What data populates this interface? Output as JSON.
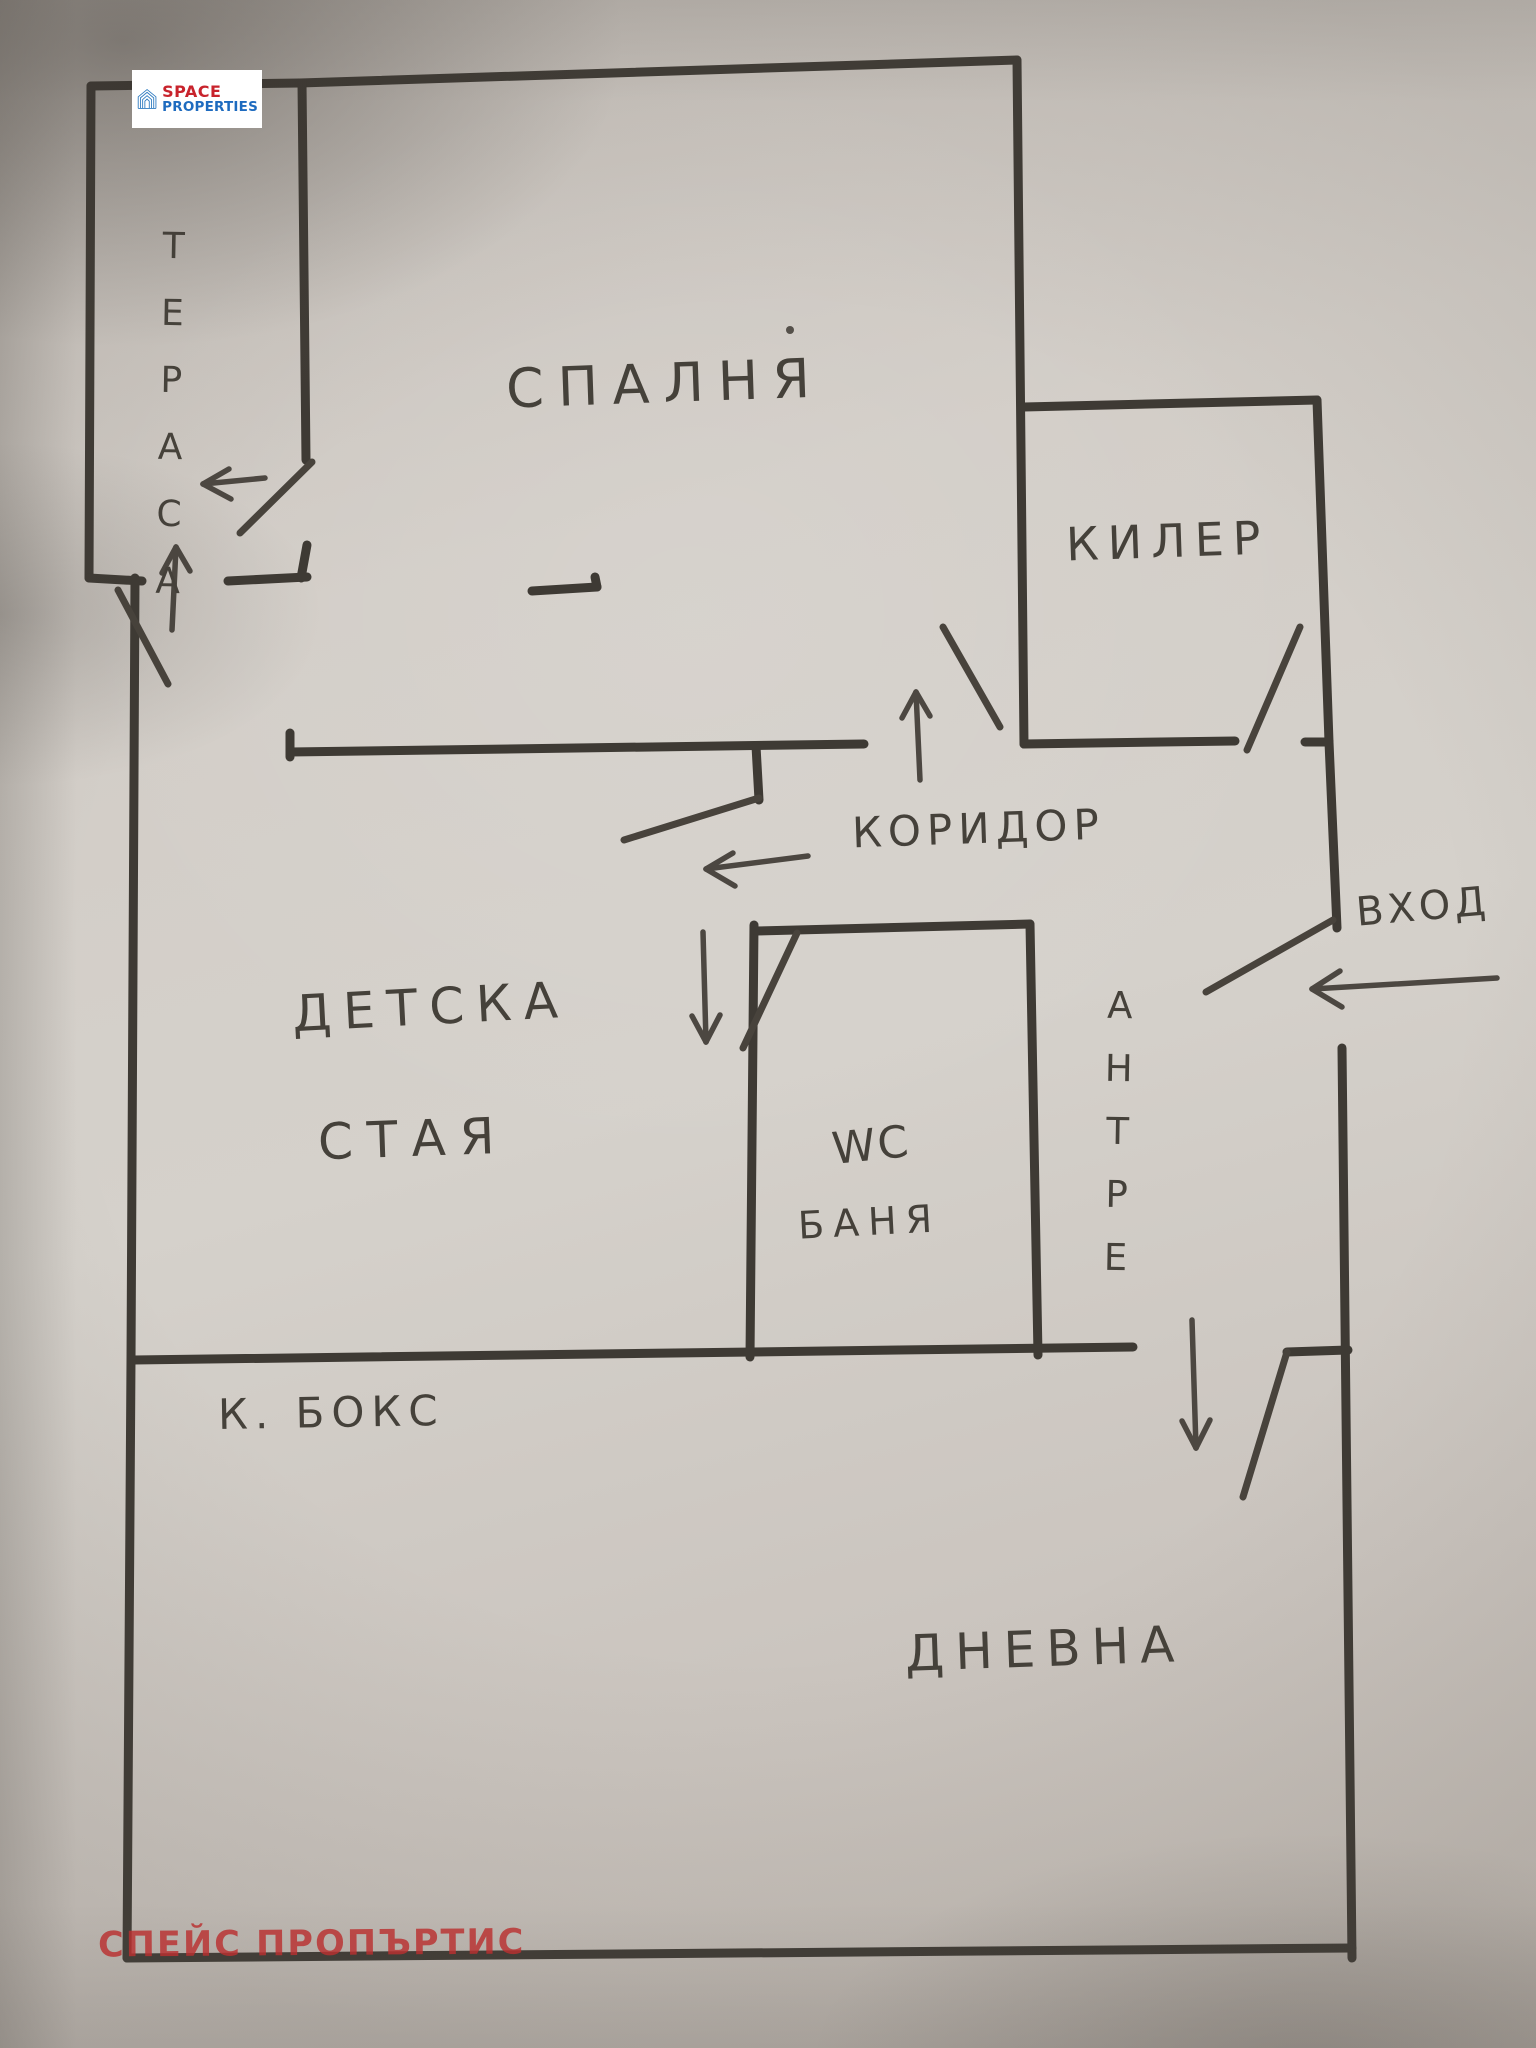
{
  "photo": {
    "description": "hand-drawn apartment floor plan sketch on paper"
  },
  "logo": {
    "space": "SPACE",
    "properties": "PROPERTIES"
  },
  "watermark": {
    "text": "СПЕЙС ПРОПЪРТИС"
  },
  "rooms": {
    "terrace": "ТЕРАСА",
    "bedroom": "СПАЛНЯ",
    "closet": "КИЛЕР",
    "corridor": "КОРИДОР",
    "entrance": "ВХОД",
    "hallway": "АНТРЕ",
    "kids_room_line1": "ДЕТСКА",
    "kids_room_line2": "СТАЯ",
    "wc": "WC",
    "bath": "БАНЯ",
    "kitchen_box": "К. БОКС",
    "living_room": "ДНЕВНА"
  },
  "colors": {
    "paper": "#ccc7c1",
    "ink": "#3e3a34",
    "logo_red": "#c8232c",
    "logo_blue": "#1e6bbf",
    "watermark_red": "#ba3030"
  }
}
